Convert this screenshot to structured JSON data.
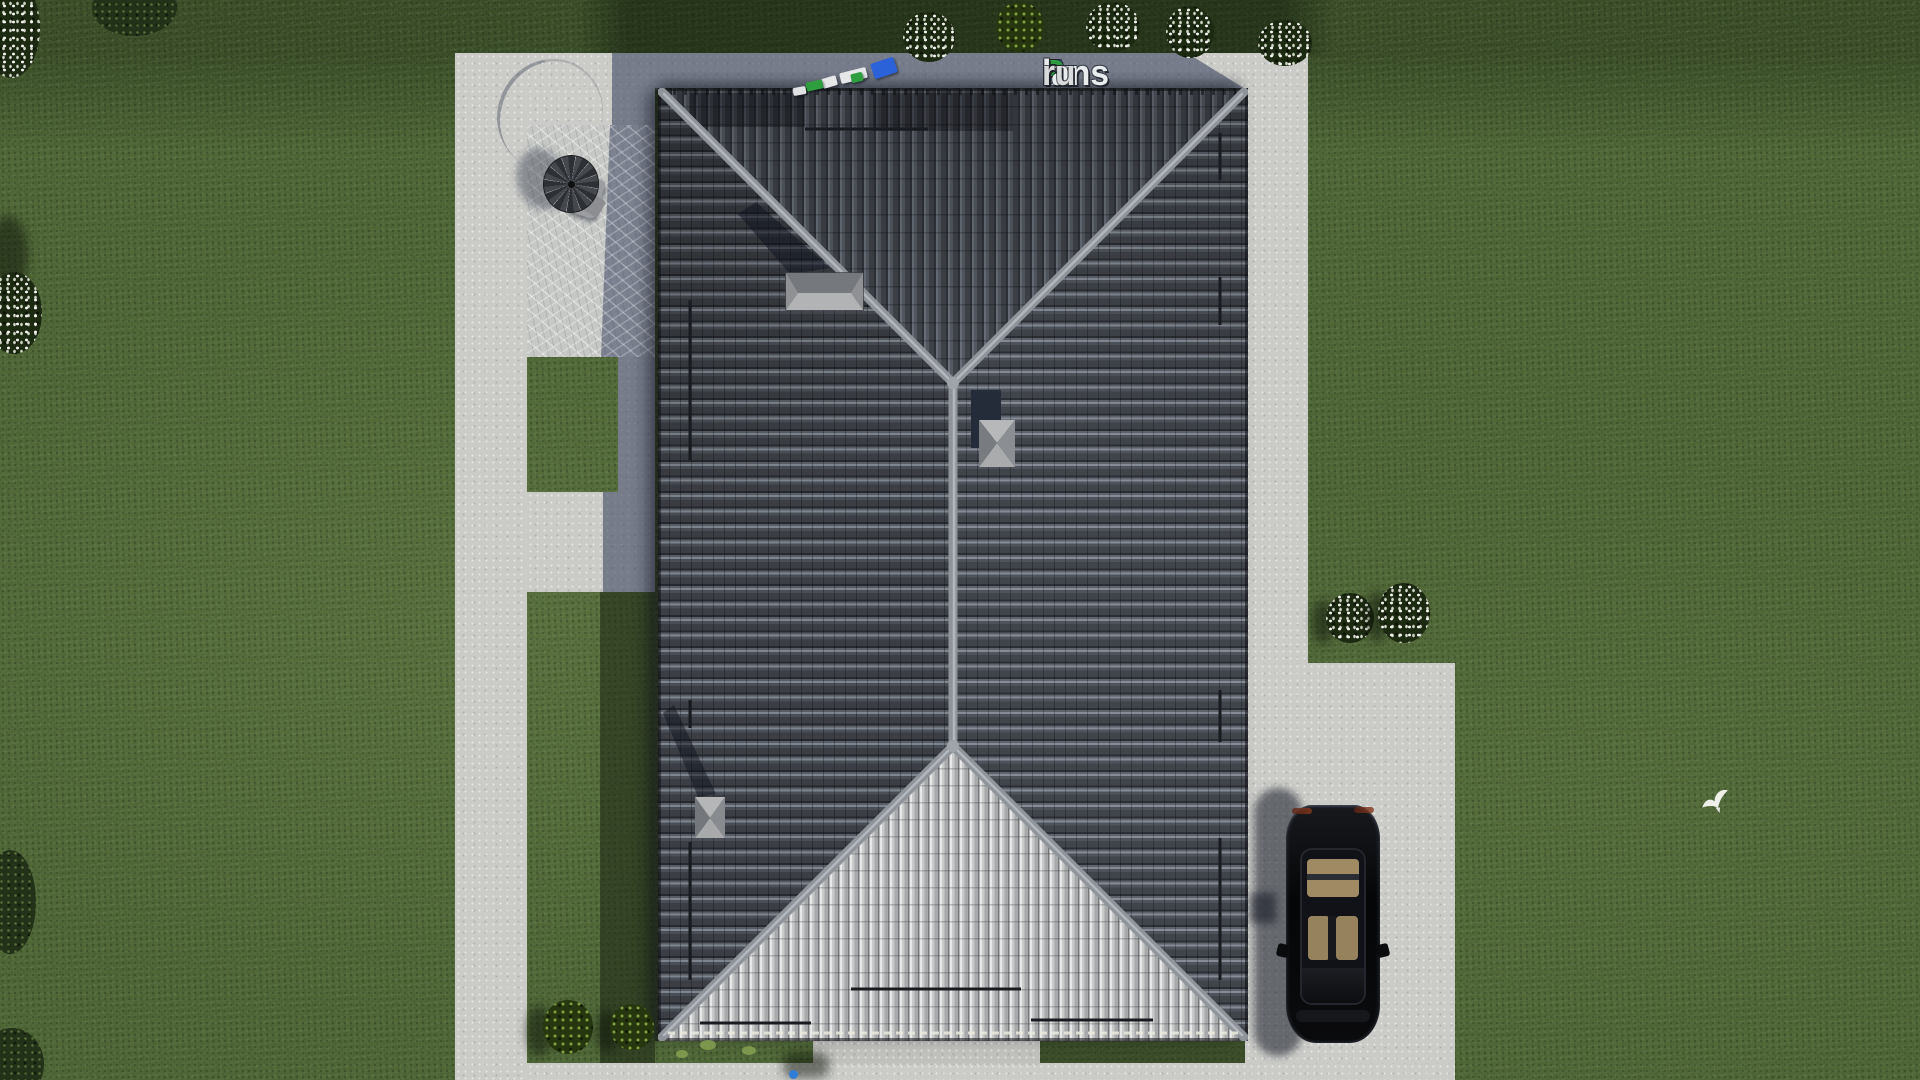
{
  "watermark": {
    "text": "FixPlans.ru",
    "segments": [
      {
        "t": "F",
        "c": "#2857c8"
      },
      {
        "t": "ix",
        "c": "#e9ecee"
      },
      {
        "t": "P",
        "c": "#2f9c3f"
      },
      {
        "t": "lans",
        "c": "#e9ecee"
      },
      {
        "t": ".",
        "c": "#31a3ea"
      },
      {
        "t": "ru",
        "c": "#d8dadc"
      }
    ]
  },
  "palette": {
    "lawn": "#4f6737",
    "lawn_dark": "#2c3d1e",
    "concrete": "#cbccc8",
    "concrete_shadow": "#5f6674",
    "roof_dark_face": "#474b52",
    "roof_bright_face": "#b4b5b6",
    "ridge_cap": "#9599a0",
    "car_body": "#0a0b0d",
    "car_interior": "#a08a64",
    "flower_white": "#f2f3ee"
  },
  "scene": {
    "view": "aerial top-down 3D render",
    "objects": [
      "hip-roof house with dark tiles",
      "concrete walkways and terrace",
      "patio parasol with table",
      "black car on driveway",
      "white flowering bushes",
      "green shrubs and trees",
      "white bird on lawn"
    ]
  }
}
